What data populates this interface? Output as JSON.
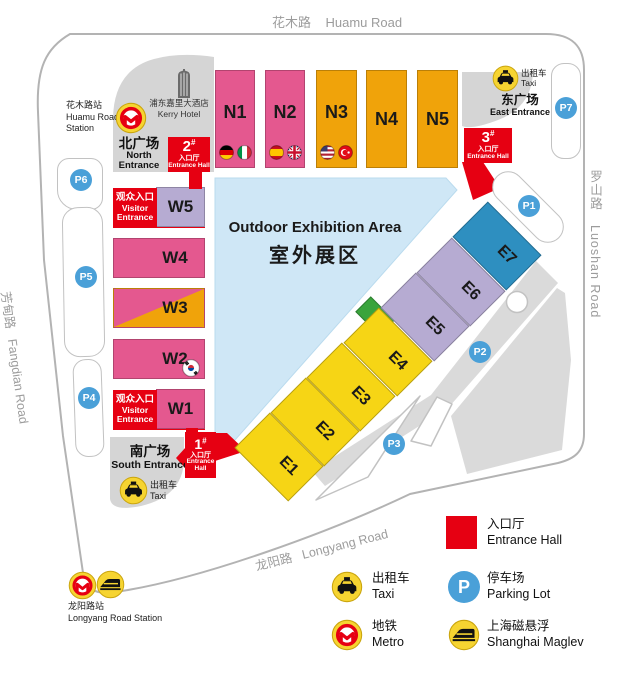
{
  "roads": {
    "huamu_cn": "花木路",
    "huamu_en": "Huamu Road",
    "luoshan_cn": "罗山路",
    "luoshan_en": "Luoshan Road",
    "fangdian_cn": "芳甸路",
    "fangdian_en": "Fangdian Road",
    "longyang_cn": "龙阳路",
    "longyang_en": "Longyang Road"
  },
  "stations": {
    "huamu": {
      "cn": "花木路站",
      "en1": "Huamu Road",
      "en2": "Station"
    },
    "longyang": {
      "cn": "龙阳路站",
      "en": "Longyang Road Station"
    }
  },
  "hotel": {
    "cn": "浦东嘉里大酒店",
    "en": "Kerry Hotel"
  },
  "entrances": {
    "north": {
      "cn": "北广场",
      "en1": "North",
      "en2": "Entrance"
    },
    "east": {
      "cn": "东广场",
      "en": "East Entrance"
    },
    "south": {
      "cn": "南广场",
      "en": "South Entrance"
    }
  },
  "taxi": {
    "cn": "出租车",
    "en": "Taxi"
  },
  "visitor": {
    "cn": "观众入口",
    "en1": "Visitor",
    "en2": "Entrance"
  },
  "entrance_halls": {
    "hash": "#",
    "h1": {
      "num": "1",
      "cn": "入口厅",
      "en1": "Entrance",
      "en2": "Hall"
    },
    "h2": {
      "num": "2",
      "cn": "入口厅",
      "en": "Entrance Hall"
    },
    "h3": {
      "num": "3",
      "cn": "入口厅",
      "en": "Entrance Hall"
    }
  },
  "outdoor": {
    "en": "Outdoor Exhibition Area",
    "cn": "室外展区"
  },
  "halls": {
    "n": [
      {
        "label": "N1"
      },
      {
        "label": "N2"
      },
      {
        "label": "N3"
      },
      {
        "label": "N4"
      },
      {
        "label": "N5"
      }
    ],
    "w": [
      {
        "label": "W5"
      },
      {
        "label": "W4"
      },
      {
        "label": "W3"
      },
      {
        "label": "W2"
      },
      {
        "label": "W1"
      }
    ],
    "e": [
      {
        "label": "E1"
      },
      {
        "label": "E2"
      },
      {
        "label": "E3"
      },
      {
        "label": "E4"
      },
      {
        "label": "E5"
      },
      {
        "label": "E6"
      },
      {
        "label": "E7"
      }
    ]
  },
  "parking": {
    "p1": "P1",
    "p2": "P2",
    "p3": "P3",
    "p4": "P4",
    "p5": "P5",
    "p6": "P6",
    "p7": "P7",
    "legend_p": "P"
  },
  "legend": {
    "entrance_hall": {
      "cn": "入口厅",
      "en": "Entrance Hall"
    },
    "taxi": {
      "cn": "出租车",
      "en": "Taxi"
    },
    "parking": {
      "cn": "停车场",
      "en": "Parking Lot"
    },
    "metro": {
      "cn": "地铁",
      "en": "Metro"
    },
    "maglev": {
      "cn": "上海磁悬浮",
      "en": "Shanghai Maglev"
    }
  },
  "colors": {
    "pink": "#e4588f",
    "orange": "#f0a30a",
    "yellow": "#f6d515",
    "lavender": "#b6abd2",
    "blue": "#2e8fc0",
    "green": "#3aa43c",
    "red": "#e60012",
    "parking": "#4aa0d8",
    "outdoor": "#cfe7f6",
    "plaza": "#d5d5d5",
    "roadline": "#b3b3b3",
    "iconyellow": "#f6d431"
  }
}
